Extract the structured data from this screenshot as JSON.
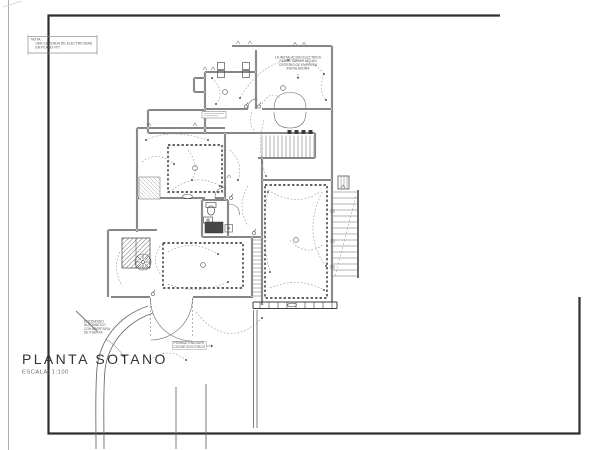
{
  "sheet": {
    "title": "PLANTA SOTANO",
    "scale_label": "ESCALA: 1:100",
    "nota_box": {
      "heading": "NOTA:",
      "lines": [
        "VER LEYENDA DE ELECTRICIDAD",
        "EN PLANO Nº7"
      ]
    },
    "annotations": {
      "installer_note": {
        "lines": [
          "LA INSTALACION ELECTRICA",
          "PUEDE VARIAR SEGUN",
          "CRITERIO DE EMPRESA",
          "INSTALADORA"
        ]
      },
      "auto_on_note": {
        "lines": [
          "ENCENDIDO",
          "AUTOMATICO",
          "CON APERTURA",
          "DE PUERTA"
        ]
      },
      "ev_socket_note": {
        "lines": [
          "POSIBLE ENCHUFE",
          "COCHE ELECTRICO"
        ]
      }
    }
  },
  "colors": {
    "paper": "#ffffff",
    "frame": "#2e2e2e",
    "walls": "#3d3d3d",
    "wiring": "#8f8f8f",
    "text": "#4a4a4a"
  }
}
